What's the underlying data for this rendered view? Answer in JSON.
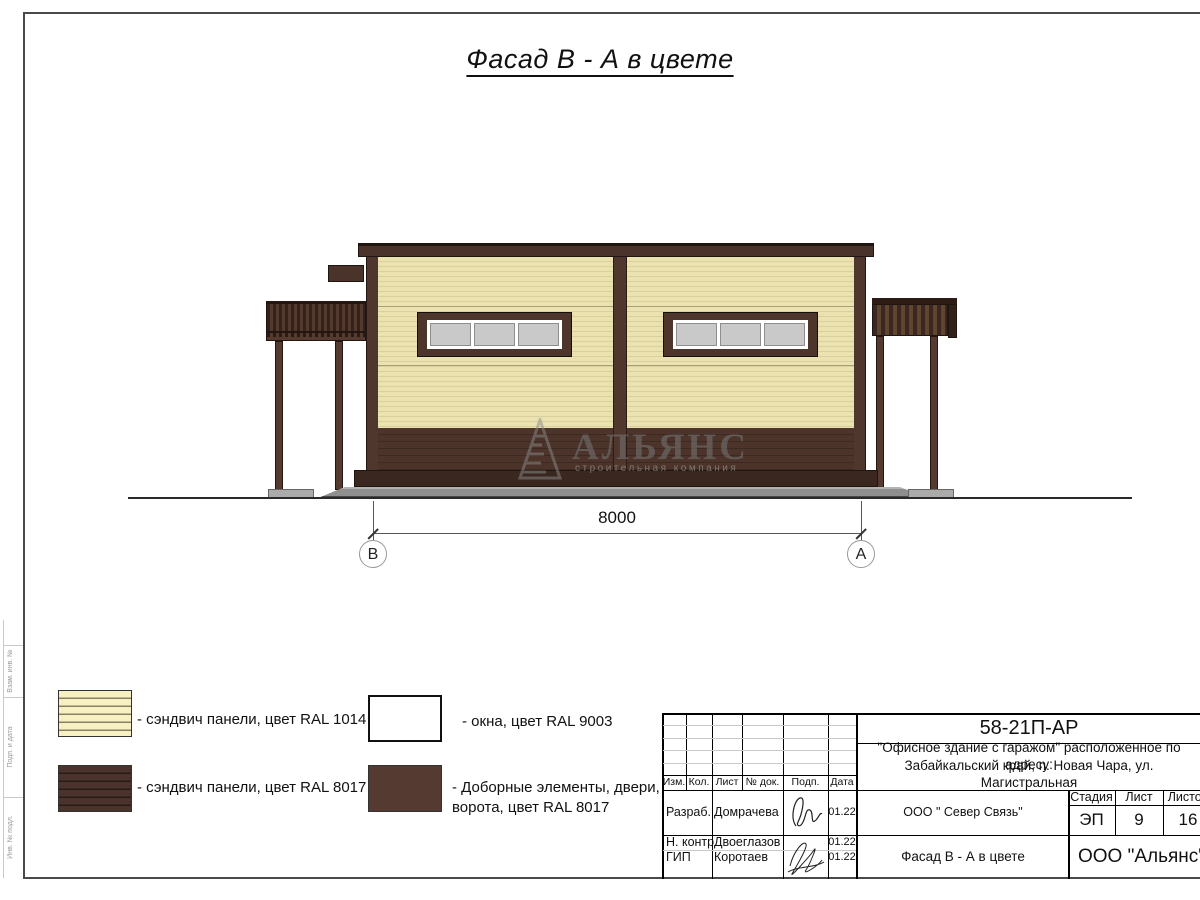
{
  "sheet": {
    "title": "Фасад В - А в цвете"
  },
  "drawing": {
    "dimension_label": "8000",
    "axis_left": "В",
    "axis_right": "А"
  },
  "watermark": {
    "name": "АЛЬЯНС",
    "tagline": "строительная компания"
  },
  "legend": {
    "items": [
      {
        "swatch": "sandwich-cream",
        "label": "- сэндвич панели, цвет RAL 1014"
      },
      {
        "swatch": "sandwich-brown",
        "label": "- сэндвич панели, цвет RAL 8017"
      },
      {
        "swatch": "window-white",
        "label": "- окна, цвет RAL 9003"
      },
      {
        "swatch": "extras-brown",
        "label": "- Доборные элементы, двери, ворота, цвет RAL 8017"
      }
    ]
  },
  "side_strip": {
    "labels": [
      "Взам. инв. №",
      "Подп. и дата",
      "Инв. № подл."
    ]
  },
  "stamp": {
    "doc_number": "58-21П-АР",
    "project_line1": "\"Офисное здание с гаражом\" расположенное по адресу:",
    "project_line2": "Забайкальский край, п. Новая Чара, ул. Магистральная",
    "columns": {
      "izm": "Изм.",
      "kol": "Кол.",
      "list": "Лист",
      "ndok": "№ док.",
      "podp": "Подп.",
      "data": "Дата"
    },
    "rows": [
      {
        "role": "Разраб.",
        "name": "Домрачева",
        "date": "01.22"
      },
      {
        "role": "Н. контр.",
        "name": "Двоеглазов",
        "date": "01.22"
      },
      {
        "role": "ГИП",
        "name": "Коротаев",
        "date": "01.22"
      }
    ],
    "org": "ООО \" Север Связь\"",
    "sheet_name": "Фасад В - А в цвете",
    "company": "ООО \"Альянс\"",
    "stage_label": "Стадия",
    "stage_value": "ЭП",
    "list_label": "Лист",
    "list_value": "9",
    "listov_label": "Листов",
    "listov_value": "16"
  },
  "colors": {
    "ral1014_cream": "#EBE2AF",
    "ral8017_brown": "#4A332B",
    "ral9003_white": "#FFFFFF",
    "window_glass": "#CBCBCB"
  }
}
